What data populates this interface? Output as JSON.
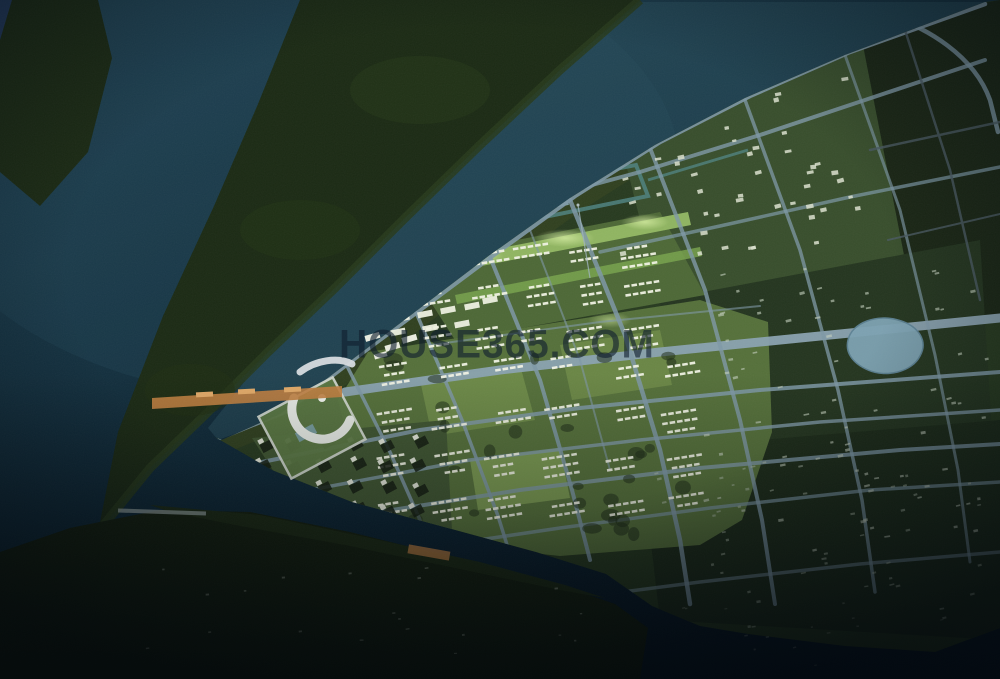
{
  "watermark": {
    "text": "HOUSE365.COM"
  },
  "scene": {
    "type": "aerial-night-render",
    "description": "Bird's-eye night rendering of a riverside urban master plan: a developed peninsula with a gridded road network and green blocks, surrounded by dark water; a forested spit to the northwest separated by a water channel; a circular civic plaza with an orange axis bridge at the western tip; a brightly lit central park axis; a small lake among the eastern blocks; a river with an elongated island and dark forest along the southern edge.",
    "regions": [
      "open-water",
      "forested-spit",
      "water-channel",
      "main-peninsula",
      "central-residential-blocks",
      "northeast-blocks",
      "eastern-dark-blocks",
      "civic-horseshoe-plaza",
      "ceremonial-axis-bridge",
      "linear-park-axis",
      "lake",
      "canal-loop",
      "river",
      "river-island",
      "pier",
      "southern-forest",
      "southwest-villa-blocks"
    ],
    "colors": {
      "water_deep": "#081824",
      "water_mid": "#143140",
      "water_light": "#1f4152",
      "channel": "#29505e",
      "forest_dark": "#141f0e",
      "spit": "#1b2a14",
      "peninsula": "#273a1f",
      "shore_trees": "#32411f",
      "block_bright": "#55703a",
      "block_mid": "#4d6836",
      "lawn": "#6f8c49",
      "park_strip": "#93b964",
      "park_glow": "#d8efa4",
      "road_light": "#7e98a6",
      "road_main": "#8aa2b0",
      "road_dark": "#4a5a62",
      "building_white": "#f0f2e4",
      "building_dim": "#c6cfbe",
      "civic_white": "#e4e8e2",
      "axis_orange": "#c08040",
      "axis_bright": "#e2aa68",
      "lake": "#7da2b2",
      "canal": "#4f8280",
      "island": "#1c2a14",
      "island_field": "#b07840"
    }
  }
}
